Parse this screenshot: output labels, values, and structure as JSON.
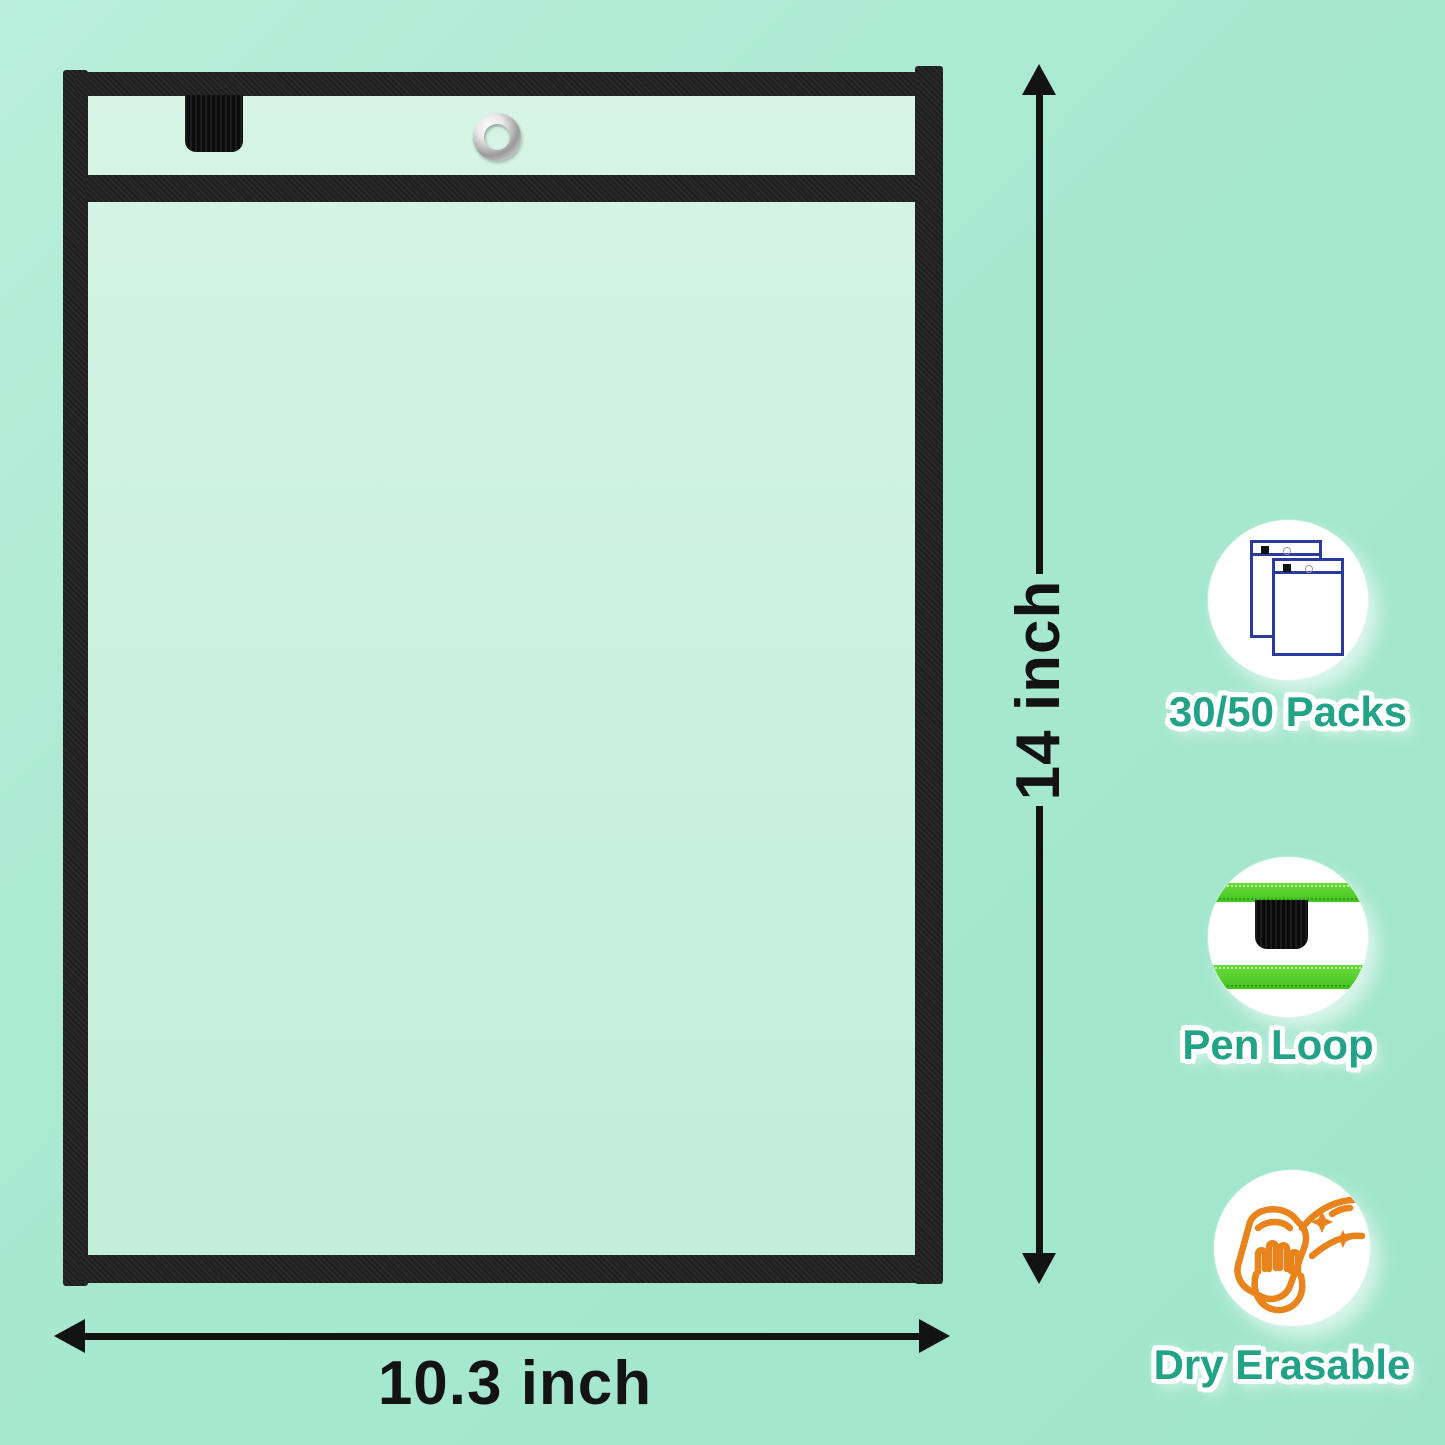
{
  "dimensions": {
    "height_label": "14 inch",
    "width_label": "10.3 inch"
  },
  "features": [
    {
      "label": "30/50 Packs",
      "icon": "packs-icon"
    },
    {
      "label": "Pen Loop",
      "icon": "pen-loop-icon"
    },
    {
      "label": "Dry Erasable",
      "icon": "dry-erasable-icon"
    }
  ],
  "colors": {
    "background_mint": "#a8e8d1",
    "pocket_interior": "#cdf1e1",
    "frame_black": "#1f1f1f",
    "label_teal": "#22a287",
    "packs_icon_blue": "#2b3a9e",
    "erase_icon_orange": "#e8841b",
    "loop_stripe_green": "#55cf2c",
    "dimension_black": "#131313",
    "grommet_silver": "#c9c9c9"
  }
}
